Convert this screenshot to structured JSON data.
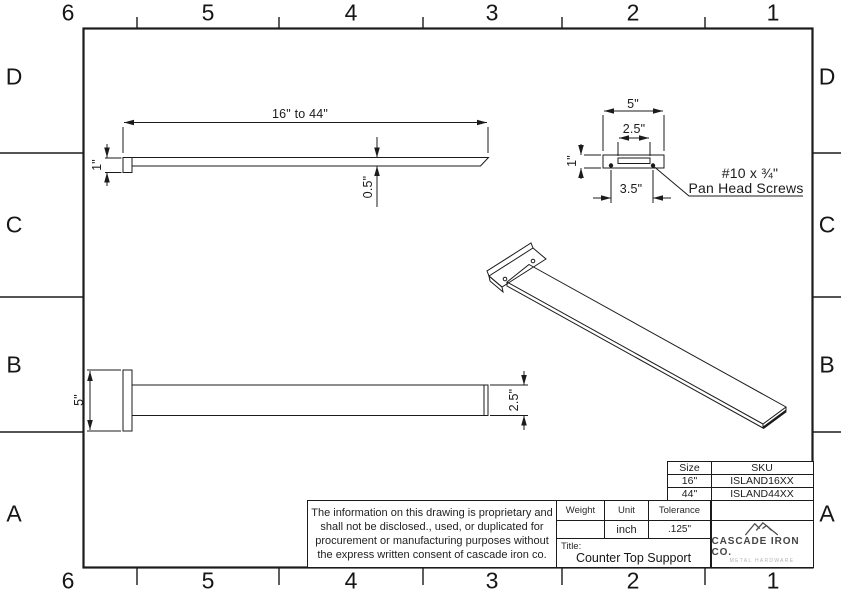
{
  "sheet": {
    "cols": [
      "6",
      "5",
      "4",
      "3",
      "2",
      "1"
    ],
    "rows": [
      "D",
      "C",
      "B",
      "A"
    ]
  },
  "views": {
    "side": {
      "length": "16\" to 44\"",
      "plate_height": "1\"",
      "bar_thickness": "0.5\""
    },
    "front": {
      "plate_width": "5\"",
      "slot_width": "2.5\"",
      "plate_height": "1\"",
      "hole_spacing": "3.5\"",
      "screw_note_line1": "#10 x ¾\"",
      "screw_note_line2": "Pan Head Screws"
    },
    "top": {
      "plate_width": "5\"",
      "bar_width": "2.5\""
    }
  },
  "title_block": {
    "notice": "The information on this drawing is proprietary and\nshall not be disclosed., used, or duplicated for\nprocurement or manufacturing purposes without\nthe express written consent of cascade iron co.",
    "weight_label": "Weight",
    "unit_label": "Unit",
    "tolerance_label": "Tolerance",
    "weight_value": "",
    "unit_value": "inch",
    "tolerance_value": ".125\"",
    "title_label": "Title:",
    "title_value": "Counter Top Support",
    "logo_name": "CASCADE IRON CO.",
    "logo_tagline": "METAL HARDWARE"
  },
  "sku_table": {
    "headers": [
      "Size",
      "SKU"
    ],
    "rows": [
      [
        "16\"",
        "ISLAND16XX"
      ],
      [
        "44\"",
        "ISLAND44XX"
      ]
    ]
  },
  "colors": {
    "line": "#1b1b1b",
    "logo_gray": "#4a4a4a",
    "tagline_gray": "#b3b3b3"
  }
}
